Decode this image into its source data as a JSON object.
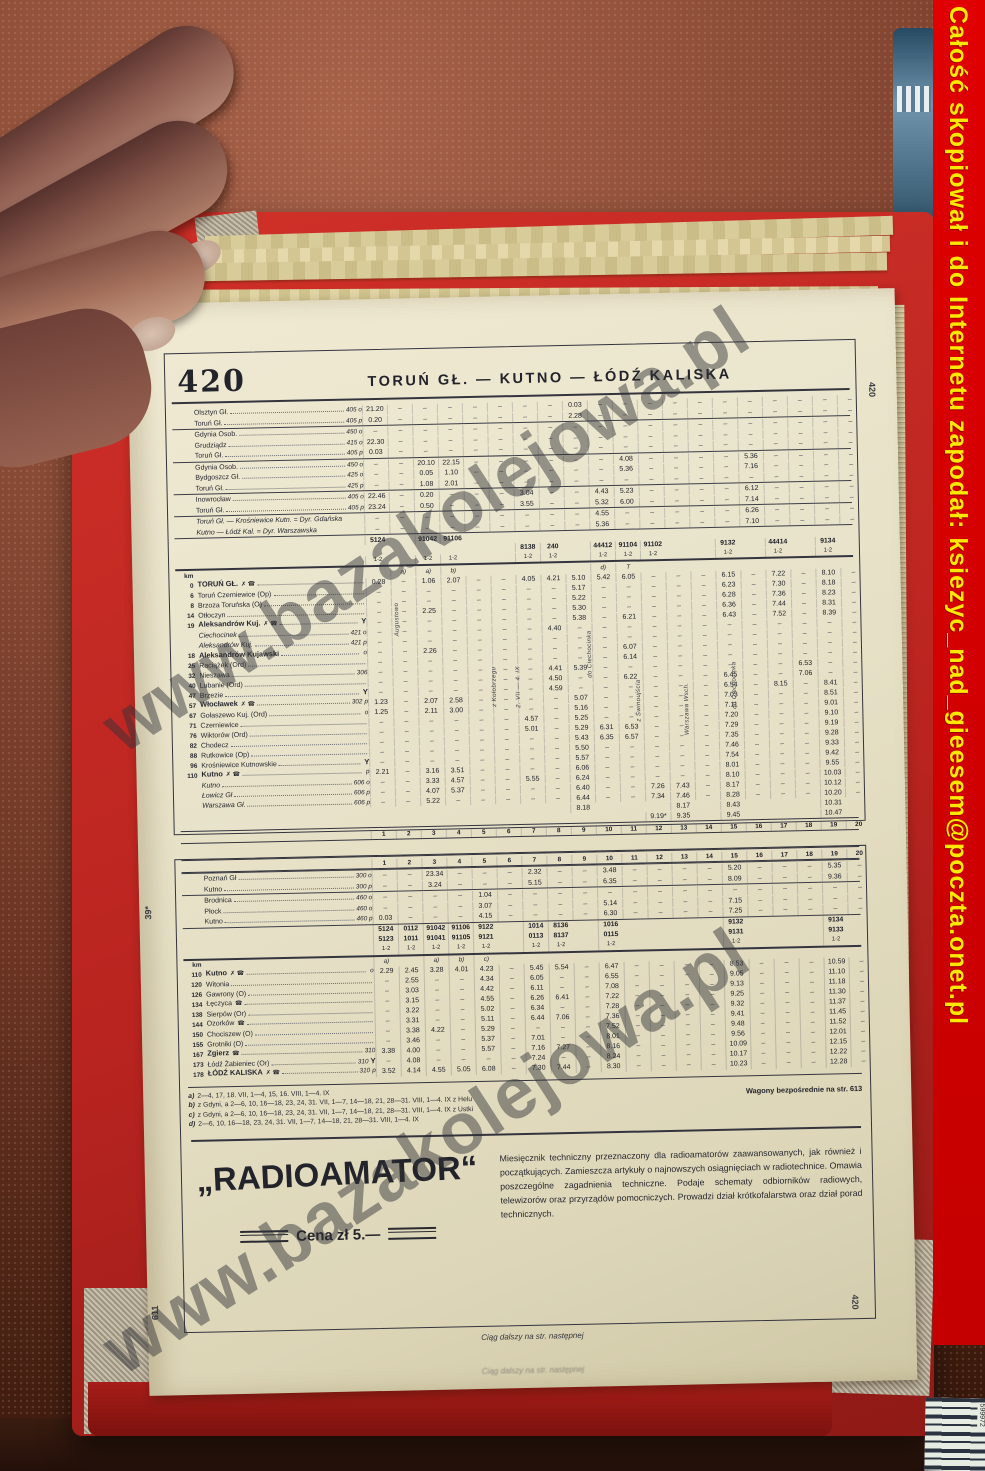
{
  "banner": {
    "text": "Całość skopiował i do Internetu zapodał: ksiezyc_nad_gieesem@poczta.onet.pl"
  },
  "watermark": {
    "text": "www.bazakolejowa.pl"
  },
  "photo": {
    "barcode_digits": "599972"
  },
  "page": {
    "margin_top_left": "610",
    "margin_mid_left": "39*",
    "margin_bottom_left": "611",
    "side_tab_top": "420",
    "side_tab_bottom": "420",
    "table_number": "420",
    "title": "TORUŃ GŁ. — KUTNO — ŁÓDŹ KALISKA",
    "km_label": "km",
    "continuation": "Ciąg dalszy na str. następnej"
  },
  "upper_table": {
    "col_numbers": [
      "1",
      "2",
      "3",
      "4",
      "5",
      "6",
      "7",
      "8",
      "9",
      "10",
      "11",
      "12",
      "13",
      "14",
      "15",
      "16",
      "17",
      "18",
      "19",
      "20"
    ],
    "connections": [
      {
        "rows": [
          {
            "name": "Olsztyn Gł.",
            "ref": "405 o",
            "t": {
              "1": "21.20",
              "9": "0.03"
            }
          },
          {
            "name": "Toruń Gł.",
            "ref": "405 p",
            "t": {
              "1": "0.20",
              "9": "2.28"
            }
          }
        ]
      },
      {
        "rows": [
          {
            "name": "Gdynia Osob.",
            "ref": "450 o",
            "t": {}
          },
          {
            "name": "Grudziądz",
            "ref": "415 o",
            "t": {
              "1": "22.30"
            }
          },
          {
            "name": "Toruń Gł.",
            "ref": "405 p",
            "t": {
              "1": "0.03"
            }
          }
        ]
      },
      {
        "rows": [
          {
            "name": "Gdynia Osob.",
            "ref": "450 o",
            "t": {
              "3": "20.10",
              "4": "22.15",
              "11": "4.08",
              "16": "5.36"
            }
          },
          {
            "name": "Bydgoszcz Gł.",
            "ref": "425 o",
            "t": {
              "3": "0.05",
              "4": "1.10",
              "11": "5.36",
              "16": "7.16"
            }
          },
          {
            "name": "Toruń Gł.",
            "ref": "425 p",
            "t": {
              "3": "1.08",
              "4": "2.01"
            }
          }
        ]
      },
      {
        "rows": [
          {
            "name": "Inowrocław",
            "ref": "405 o",
            "t": {
              "1": "22.46",
              "3": "0.20",
              "7": "3.04",
              "10": "4.43",
              "11": "5.23",
              "16": "6.12"
            }
          },
          {
            "name": "Toruń Gł.",
            "ref": "405 p",
            "t": {
              "1": "23.24",
              "3": "0.50",
              "7": "3.55",
              "10": "5.32",
              "11": "6.00",
              "16": "7.14"
            }
          }
        ]
      },
      {
        "rows": [
          {
            "name": "Toruń Gł. — Krośniewice Kutn. = Dyr. Gdańska",
            "noleader": true,
            "italic": true,
            "t": {
              "10": "4.55",
              "16": "6.26"
            }
          },
          {
            "name": "Kutno — Łódź Kal. = Dyr. Warszawska",
            "noleader": true,
            "italic": true,
            "t": {
              "10": "5.36",
              "16": "7.10"
            }
          }
        ]
      }
    ],
    "train_numbers": [
      {
        "1": "5124",
        "3": "91042",
        "4": "91106"
      },
      {
        "7": "8138",
        "8": "240",
        "10": "44412",
        "11": "91104",
        "12": "91102",
        "15": "9132",
        "17": "44414",
        "19": "9134"
      }
    ],
    "class_label": "1-2",
    "class_cols": [
      1,
      3,
      4,
      7,
      8,
      10,
      11,
      12,
      15,
      17,
      19
    ],
    "letters": {
      "2": "a)",
      "3": "a)",
      "4": "b)",
      "10": "d)",
      "11": "T"
    },
    "vertical_notes": [
      {
        "col": 2,
        "top": 26,
        "text": "Augustowo"
      },
      {
        "col": 6,
        "top": 92,
        "text": "z Kołobrzegu"
      },
      {
        "col": 7,
        "top": 92,
        "text": "2. VII — 4. IX"
      },
      {
        "col": 10,
        "top": 58,
        "text": "do Ciechocinka"
      },
      {
        "col": 12,
        "top": 108,
        "text": "z Świnoujścia"
      },
      {
        "col": 14,
        "top": 112,
        "text": "Warszawa Wsch."
      },
      {
        "col": 16,
        "top": 92,
        "text": "do Ciechocinka"
      }
    ],
    "stations": [
      {
        "km": "0",
        "name": "TORUŃ GŁ.",
        "sym": "✗ ☎",
        "bold": true,
        "t": {
          "1": "0.28",
          "3": "1.06",
          "4": "2.07",
          "7": "4.05",
          "8": "4.21",
          "9": "5.10",
          "10": "5.42",
          "11": "6.05",
          "15": "6.15",
          "17": "7.22",
          "19": "8.10"
        }
      },
      {
        "km": "6",
        "name": "Toruń Czerniewice (Op)",
        "t": {
          "9": "5.17",
          "15": "6.23",
          "17": "7.30",
          "19": "8.18"
        }
      },
      {
        "km": "8",
        "name": "Brzoza Toruńska (O)",
        "t": {
          "9": "5.22",
          "15": "6.28",
          "17": "7.36",
          "19": "8.23"
        }
      },
      {
        "km": "14",
        "name": "Otłoczyn",
        "t": {
          "3": "2.25",
          "9": "5.30",
          "15": "6.36",
          "17": "7.44",
          "19": "8.31"
        }
      },
      {
        "km": "19",
        "name": "Aleksandrów Kuj.",
        "sym": "✗ ☎",
        "bold": true,
        "tail": "Y",
        "t": {
          "9": "5.38",
          "11": "6.21",
          "15": "6.43",
          "17": "7.52",
          "19": "8.39"
        }
      },
      {
        "km": "",
        "name": "Ciechocinek",
        "ref": "421 o",
        "italic": true,
        "t": {
          "8": "4.40"
        }
      },
      {
        "km": "",
        "name": "Aleksandrów Kuj.",
        "ref": "421 p",
        "italic": true,
        "t": {}
      },
      {
        "km": "18",
        "name": "Aleksandrów Kujawski",
        "bold": true,
        "adl": "o",
        "t": {
          "3": "2.26",
          "11": "6.07"
        }
      },
      {
        "km": "25",
        "name": "Raciążek (Ord)",
        "t": {
          "11": "6.14"
        }
      },
      {
        "km": "32",
        "name": "Nieszawa",
        "ref": "306",
        "t": {
          "8": "4.41",
          "9": "5.39",
          "18": "6.53"
        }
      },
      {
        "km": "40",
        "name": "Lubanie (Ord)",
        "t": {
          "8": "4.50",
          "11": "6.22",
          "15": "6.45",
          "18": "7.06"
        }
      },
      {
        "km": "47",
        "name": "Brzezie",
        "tail": "Y",
        "t": {
          "8": "4.59",
          "15": "6.54",
          "17": "8.15",
          "19": "8.41"
        }
      },
      {
        "km": "57",
        "name": "Włocławek",
        "sym": "✗ ☎",
        "ref": "302",
        "adl": "p",
        "bold": true,
        "t": {
          "1": "1.23",
          "3": "2.07",
          "4": "2.58",
          "9": "5.07",
          "15": "7.03",
          "19": "8.51"
        }
      },
      {
        "km": "67",
        "name": "Gołaszewo Kuj. (Ord)",
        "adl": "o",
        "t": {
          "1": "1.25",
          "3": "2.11",
          "4": "3.00",
          "9": "5.16",
          "15": "7.11",
          "19": "9.01"
        }
      },
      {
        "km": "71",
        "name": "Czerniewice",
        "t": {
          "7": "4.57",
          "9": "5.25",
          "15": "7.20",
          "19": "9.10"
        }
      },
      {
        "km": "76",
        "name": "Wiktorów (Ord)",
        "t": {
          "7": "5.01",
          "9": "5.29",
          "10": "6.31",
          "11": "6.53",
          "15": "7.29",
          "19": "9.19"
        }
      },
      {
        "km": "82",
        "name": "Chodecz",
        "t": {
          "9": "5.43",
          "10": "6.35",
          "11": "6.57",
          "15": "7.35",
          "19": "9.28"
        }
      },
      {
        "km": "88",
        "name": "Rutkowice (Op)",
        "t": {
          "9": "5.50",
          "15": "7.46",
          "19": "9.33"
        }
      },
      {
        "km": "96",
        "name": "Krośniewice Kutnowskie",
        "tail": "Y",
        "t": {
          "9": "5.57",
          "15": "7.54",
          "19": "9.42"
        }
      },
      {
        "km": "110",
        "name": "Kutno",
        "sym": "✗ ☎",
        "bold": true,
        "adl": "p",
        "t": {
          "1": "2.21",
          "3": "3.16",
          "4": "3.51",
          "9": "6.06",
          "15": "8.01",
          "19": "9.55"
        }
      },
      {
        "km": "",
        "name": "Kutno",
        "ref": "606 o",
        "italic": true,
        "t": {
          "3": "3.33",
          "4": "4.57",
          "7": "5.55",
          "9": "6.24",
          "15": "8.10",
          "19": "10.03"
        }
      },
      {
        "km": "",
        "name": "Łowicz Gł",
        "ref": "606 p",
        "italic": true,
        "t": {
          "3": "4.07",
          "4": "5.37",
          "9": "6.40",
          "12": "7.26",
          "13": "7.43",
          "15": "8.17",
          "19": "10.12"
        }
      },
      {
        "km": "",
        "name": "Warszawa Gł.",
        "ref": "606 p",
        "italic": true,
        "t": {
          "3": "5.22",
          "9": "6.44",
          "12": "7.34",
          "13": "7.46",
          "15": "8.28",
          "19": "10.20"
        }
      },
      {
        "km": "",
        "name": "",
        "noleader": true,
        "nodash": true,
        "t": {
          "9": "8.18",
          "13": "8.17",
          "15": "8.43",
          "19": "10.31"
        }
      },
      {
        "km": "",
        "name": "",
        "noleader": true,
        "nodash": true,
        "t": {
          "12": "9.19*",
          "13": "9.35",
          "15": "9.45",
          "19": "10.47"
        }
      }
    ]
  },
  "lower_table": {
    "col_numbers": [
      "1",
      "2",
      "3",
      "4",
      "5",
      "6",
      "7",
      "8",
      "9",
      "10",
      "11",
      "12",
      "13",
      "14",
      "15",
      "16",
      "17",
      "18",
      "19",
      "20"
    ],
    "connections": [
      {
        "rows": [
          {
            "name": "Poznań Gł",
            "ref": "300 o",
            "t": {
              "3": "23.34",
              "7": "2.32",
              "10": "3.48",
              "15": "5.20",
              "19": "5.35"
            }
          },
          {
            "name": "Kutno",
            "ref": "300 p",
            "t": {
              "3": "3.24",
              "7": "5.15",
              "10": "6.35",
              "15": "8.09",
              "19": "9.36"
            }
          }
        ]
      },
      {
        "rows": [
          {
            "name": "Brodnica",
            "ref": "460 o",
            "t": {
              "5": "1.04"
            }
          },
          {
            "name": "Płock",
            "ref": "460 o",
            "t": {
              "5": "3.07",
              "10": "5.14",
              "15": "7.15"
            }
          },
          {
            "name": "Kutno",
            "ref": "460 p",
            "t": {
              "1": "0.03",
              "5": "4.15",
              "10": "6.30",
              "15": "7.25"
            }
          }
        ]
      }
    ],
    "train_numbers": [
      {
        "1": "5124",
        "2": "0112",
        "3": "91042",
        "4": "91106",
        "5": "9122",
        "7": "1014",
        "8": "8136",
        "10": "1016",
        "15": "9132",
        "19": "9134"
      },
      {
        "1": "5123",
        "2": "1011",
        "3": "91041",
        "4": "91105",
        "5": "9121",
        "7": "0113",
        "8": "8137",
        "10": "0115",
        "15": "9131",
        "19": "9133"
      }
    ],
    "class_label": "1-2",
    "class_cols": [
      1,
      2,
      3,
      4,
      5,
      7,
      8,
      10,
      15,
      19
    ],
    "letters": {
      "1": "a)",
      "3": "a)",
      "4": "b)",
      "5": "c)"
    },
    "stations": [
      {
        "km": "110",
        "name": "Kutno",
        "sym": "✗ ☎",
        "bold": true,
        "adl": "o",
        "t": {
          "1": "2.29",
          "2": "2.45",
          "3": "3.28",
          "4": "4.01",
          "5": "4.23",
          "7": "5.45",
          "8": "5.54",
          "10": "6.47",
          "15": "8.53",
          "19": "10.59"
        }
      },
      {
        "km": "120",
        "name": "Witonia",
        "t": {
          "2": "2.55",
          "5": "4.34",
          "7": "6.05",
          "10": "6.55",
          "15": "9.05",
          "19": "11.10"
        }
      },
      {
        "km": "126",
        "name": "Gawrony (O)",
        "t": {
          "2": "3.03",
          "5": "4.42",
          "7": "6.11",
          "10": "7.08",
          "15": "9.13",
          "19": "11.18"
        }
      },
      {
        "km": "134",
        "name": "Łęczyca",
        "sym": "☎",
        "t": {
          "2": "3.15",
          "5": "4.55",
          "7": "6.26",
          "8": "6.41",
          "10": "7.22",
          "15": "9.25",
          "19": "11.30"
        }
      },
      {
        "km": "138",
        "name": "Sierpów (Or)",
        "t": {
          "2": "3.22",
          "5": "5.02",
          "7": "6.34",
          "10": "7.28",
          "15": "9.32",
          "19": "11.37"
        }
      },
      {
        "km": "144",
        "name": "Ozorków",
        "sym": "☎",
        "t": {
          "2": "3.31",
          "5": "5.11",
          "7": "6.44",
          "8": "7.06",
          "10": "7.36",
          "15": "9.41",
          "19": "11.45"
        }
      },
      {
        "km": "150",
        "name": "Chociszew (O)",
        "t": {
          "2": "3.38",
          "3": "4.22",
          "5": "5.29",
          "10": "7.52",
          "15": "9.48",
          "19": "11.52"
        }
      },
      {
        "km": "155",
        "name": "Grotniki (O)",
        "t": {
          "2": "3.46",
          "5": "5.37",
          "7": "7.01",
          "10": "8.01",
          "15": "9.56",
          "19": "12.01"
        }
      },
      {
        "km": "167",
        "name": "Zgierz",
        "sym": "☎",
        "ref": "310",
        "bold": true,
        "t": {
          "1": "3.38",
          "2": "4.00",
          "5": "5.57",
          "7": "7.16",
          "8": "7.27",
          "10": "8.16",
          "15": "10.09",
          "19": "12.15"
        }
      },
      {
        "km": "173",
        "name": "Łódź Żabieniec (Or)",
        "ref": "310",
        "tail": "Y",
        "t": {
          "2": "4.08",
          "7": "7.24",
          "10": "8.24",
          "15": "10.17",
          "19": "12.22"
        }
      },
      {
        "km": "178",
        "name": "ŁÓDŹ KALISKA",
        "sym": "✗ ☎",
        "ref": "310",
        "adl": "p",
        "bold": true,
        "t": {
          "1": "3.52",
          "2": "4.14",
          "3": "4.55",
          "4": "5.05",
          "5": "6.08",
          "7": "7.30",
          "8": "7.44",
          "10": "8.30",
          "15": "10.23",
          "19": "12.28"
        }
      }
    ],
    "footnotes": [
      {
        "k": "a)",
        "text": "2—4, 17, 18. VII, 1—4, 15, 16. VIII, 1—4. IX"
      },
      {
        "k": "b)",
        "text": "z Gdyni, a 2—6, 10, 16—18, 23, 24, 31. VII, 1—7, 14—18, 21, 28—31. VIII, 1—4. IX z Helu"
      },
      {
        "k": "c)",
        "text": "z Gdyni, a 2—6, 10, 16—18, 23, 24, 31. VII, 1—7, 14—18, 21, 28—31. VIII, 1—4. IX z Ustki"
      },
      {
        "k": "d)",
        "text": "2—6, 10, 16—18, 23, 24, 31. VII, 1—7, 14—18, 21, 28—31. VIII, 1—4. IX"
      }
    ],
    "wagon_note": "Wagony bezpośrednie na str. 613"
  },
  "ad": {
    "title": "„RADIOAMATOR“",
    "price": "Cena zł 5.—",
    "body": "Miesięcznik techniczny przeznaczony dla radioamatorów zaawansowanych, jak również i początkujących. Zamieszcza artykuły o najnowszych osiągnięciach w radiotechnice. Omawia poszczególne zagadnienia techniczne. Podaje schematy odbiorników radiowych, telewizorów oraz przyrządów pomocniczych. Prowadzi dział krótkofalarstwa oraz dział porad technicznych."
  }
}
